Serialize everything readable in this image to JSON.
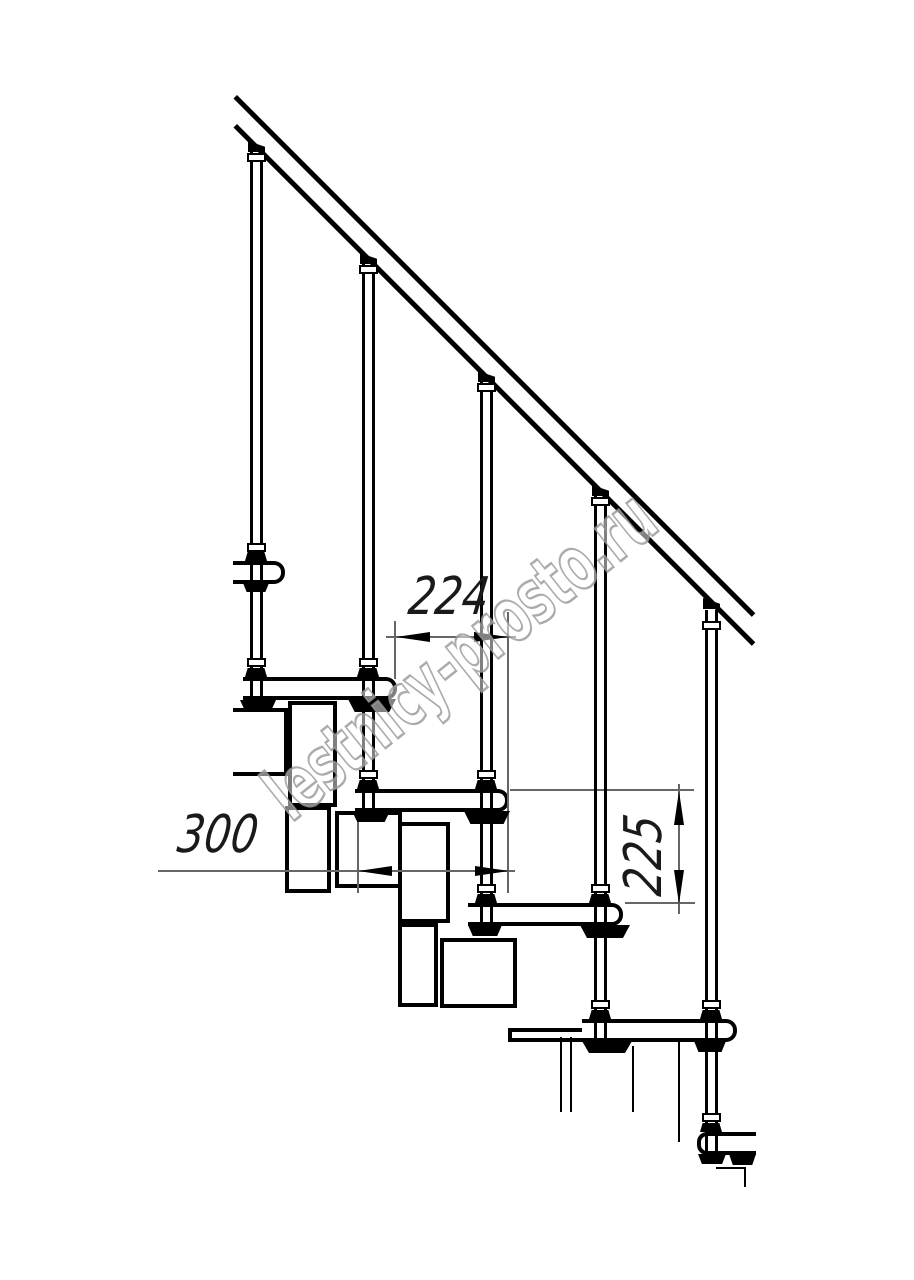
{
  "drawing": {
    "type": "technical line drawing",
    "subject": "modular staircase side-view fragment with handrail, balusters, treads and support modules",
    "background_color": "#ffffff",
    "line_color": "#000000",
    "dimension_line_color": "#666666"
  },
  "dimensions": {
    "step_run": {
      "value": "224",
      "orientation": "horizontal",
      "location": "between tread noses, upper middle"
    },
    "tread_depth": {
      "value": "300",
      "orientation": "horizontal",
      "location": "left middle"
    },
    "riser_height": {
      "value": "225",
      "orientation": "vertical",
      "location": "right middle"
    }
  },
  "watermark": {
    "text": "lestnicy-prosto.ru",
    "style": "outlined translucent diagonal"
  }
}
